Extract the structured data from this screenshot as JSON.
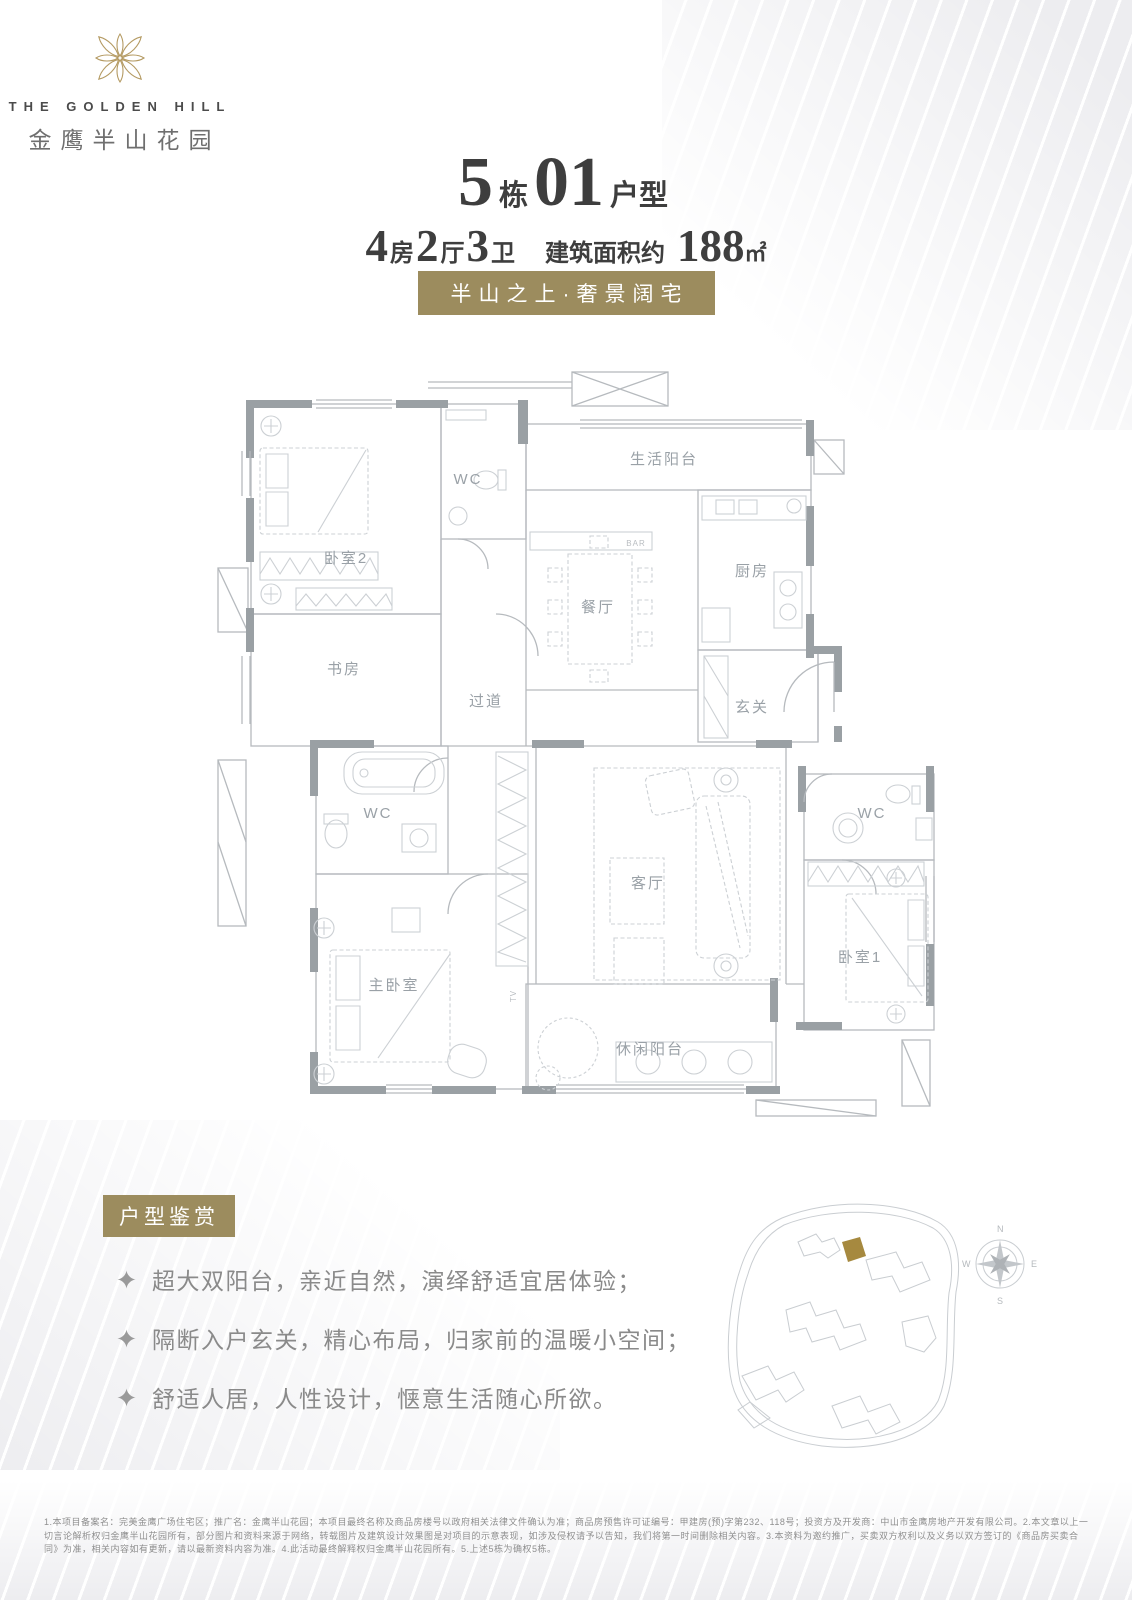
{
  "colors": {
    "gold_badge": "#9c8c5e",
    "logo_gold": "#b49a62",
    "ink": "#3e3e3e",
    "feature_text": "#8a8a8a",
    "plan_wall": "#9aa0a4",
    "plan_line": "#c2c6ca",
    "site_highlight": "#a6893f"
  },
  "logo": {
    "flower_icon": "golden-flower-ornament",
    "en": "THE GOLDEN HILL",
    "cn": "金鹰半山花园"
  },
  "title": {
    "building_number": "5",
    "building_suffix": "栋",
    "unit_number": "01",
    "unit_suffix": "户型"
  },
  "specs": {
    "beds_count": "4",
    "beds_label": "房",
    "halls_count": "2",
    "halls_label": "厅",
    "baths_count": "3",
    "baths_label": "卫",
    "area_prefix": "建筑面积约",
    "area_value": "188",
    "area_unit": "㎡"
  },
  "tagline": "半山之上·奢景阔宅",
  "floorplan": {
    "rooms": [
      "卧室2",
      "WC",
      "生活阳台",
      "厨房",
      "餐厅",
      "书房",
      "过道",
      "玄关",
      "WC",
      "客厅",
      "WC",
      "主卧室",
      "卧室1",
      "休闲阳台"
    ],
    "bar_label": "BAR",
    "tv_label": "TV"
  },
  "features": {
    "badge": "户型鉴赏",
    "items": [
      "超大双阳台，亲近自然，演绎舒适宜居体验；",
      "隔断入户玄关，精心布局，归家前的温暖小空间；",
      "舒适人居，人性设计，惬意生活随心所欲。"
    ]
  },
  "siteplan": {
    "compass": {
      "n": "N",
      "e": "E",
      "s": "S",
      "w": "W"
    }
  },
  "disclaimer": "1.本项目备案名：完美金鹰广场住宅区；推广名：金鹰半山花园；本项目最终名称及商品房楼号以政府相关法律文件确认为准；商品房预售许可证编号：甲建房(预)字第232、118号；投资方及开发商：中山市金鹰房地产开发有限公司。2.本文章以上一切言论解析权归金鹰半山花园所有，部分图片和资料来源于网络，转载图片及建筑设计效果图是对项目的示意表现，如涉及侵权请予以告知，我们将第一时间删除相关内容。3.本资料为邀约推广，买卖双方权利以及义务以双方签订的《商品房买卖合同》为准，相关内容如有更新，请以最新资料内容为准。4.此活动最终解释权归金鹰半山花园所有。5.上述5栋为确权5栋。"
}
